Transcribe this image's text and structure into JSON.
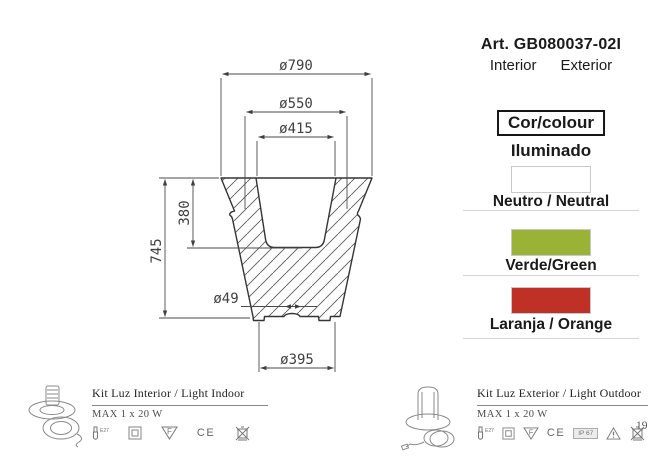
{
  "product": {
    "article": "Art. GB080037-02I",
    "interior_label": "Interior",
    "exterior_label": "Exterior"
  },
  "color_panel": {
    "header": "Cor/colour",
    "subheader": "Iluminado",
    "options": [
      {
        "label": "Neutro / Neutral",
        "color": "#ffffff"
      },
      {
        "label": "Verde/Green",
        "color": "#9ab337"
      },
      {
        "label": "Laranja / Orange",
        "color": "#bf3027"
      }
    ]
  },
  "drawing": {
    "dimensions": {
      "top_diameter": "ø790",
      "rim_diameter": "ø550",
      "opening_diameter": "ø415",
      "total_height": "745",
      "inner_depth": "380",
      "drain_diameter": "ø49",
      "base_diameter": "ø395"
    }
  },
  "footer": {
    "indoor": {
      "title": "Kit Luz Interior / Light Indoor",
      "max_power": "MAX 1 x 20 W",
      "icons": [
        "lamp-e27-icon",
        "class-ii-icon",
        "f-mark-icon",
        "ce-mark",
        "weee-bin-icon"
      ]
    },
    "outdoor": {
      "title": "Kit Luz Exterior / Light Outdoor",
      "max_power": "MAX 1 x 20 W",
      "ip_rating": "IP 67",
      "icons": [
        "lamp-e27-icon",
        "class-ii-icon",
        "f-mark-icon",
        "ce-mark",
        "ip67-badge",
        "warning-triangle-icon",
        "weee-bin-icon"
      ]
    },
    "lamp_socket": "E27",
    "ce_mark": "CE"
  },
  "page": {
    "number": "19"
  }
}
